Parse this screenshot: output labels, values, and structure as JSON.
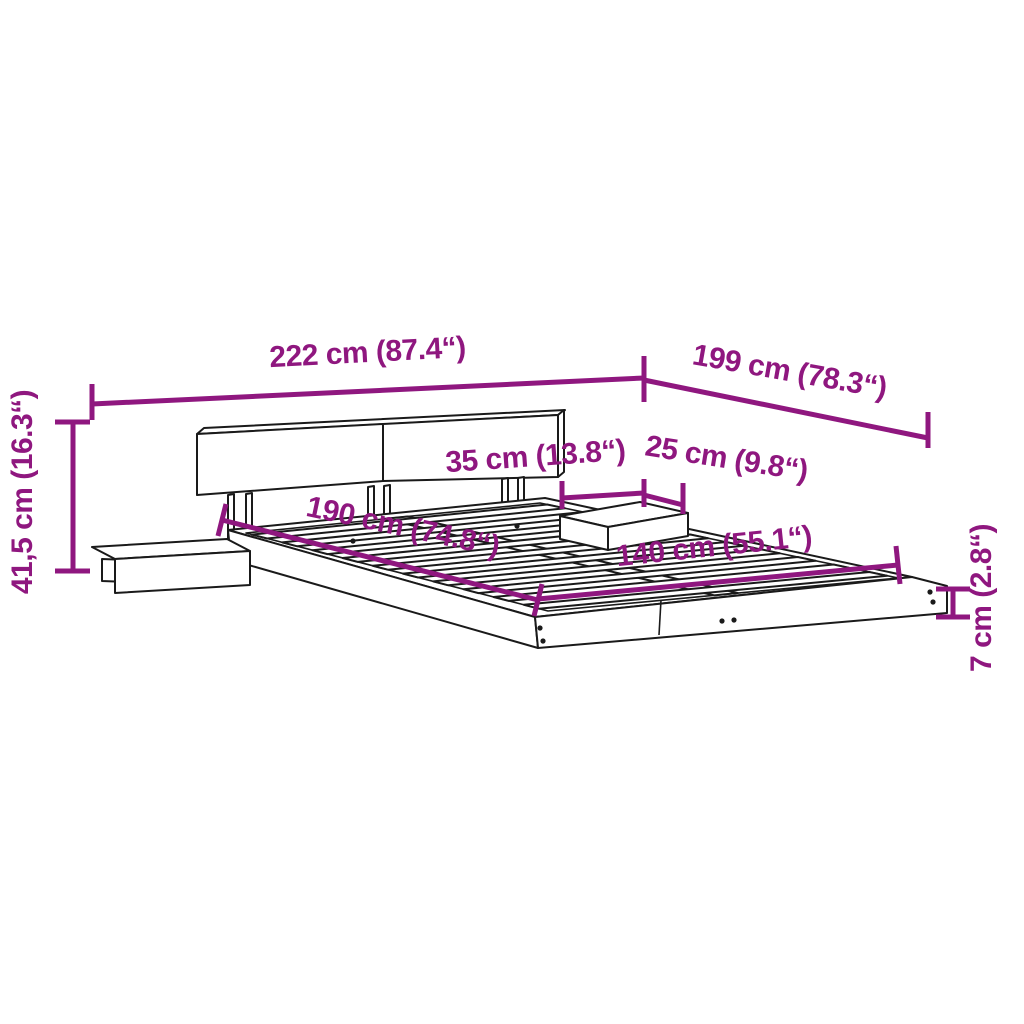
{
  "colors": {
    "dimension": "#8F177F",
    "line": "#1A1A1A",
    "background": "#FFFFFF"
  },
  "dimensions": {
    "total_width": "222 cm (87.4“)",
    "total_depth": "199 cm (78.3“)",
    "total_height": "41,5 cm (16.3“)",
    "nightstand_width": "35 cm (13.8“)",
    "nightstand_depth": "25 cm (9.8“)",
    "inner_length": "190 cm (74.8“)",
    "inner_width": "140 cm (55.1“)",
    "base_height": "7 cm (2.8“)"
  }
}
